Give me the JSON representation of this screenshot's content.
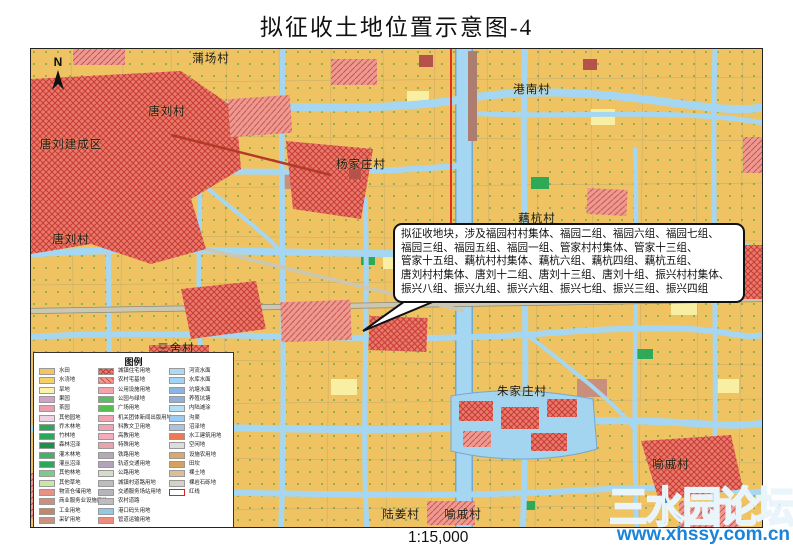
{
  "title": "拟征收土地位置示意图-4",
  "scale_label": "1:15,000",
  "north_label": "N",
  "watermark": {
    "site_name": "三水园论坛",
    "url": "www.xhssy.com.cn"
  },
  "callout": {
    "lines": [
      "拟征收地块，涉及福园村村集体、福园二组、福园六组、福园七组、",
      "福园三组、福园五组、福园一组、管家村村集体、管家十三组、",
      "管家十五组、藕杭村村集体、藕杭六组、藕杭四组、藕杭五组、",
      "唐刘村村集体、唐刘十二组、唐刘十三组、唐刘十组、振兴村村集体、",
      "振兴八组、振兴九组、振兴六组、振兴七组、振兴三组、振兴四组"
    ]
  },
  "map": {
    "labels": [
      {
        "text": "蒲场村",
        "x": 180,
        "y": 9
      },
      {
        "text": "港南村",
        "x": 501,
        "y": 40
      },
      {
        "text": "唐刘村",
        "x": 136,
        "y": 62
      },
      {
        "text": "唐刘建成区",
        "x": 40,
        "y": 95
      },
      {
        "text": "杨家庄村",
        "x": 330,
        "y": 115
      },
      {
        "text": "唐刘村",
        "x": 40,
        "y": 190
      },
      {
        "text": "藕杭村",
        "x": 506,
        "y": 169
      },
      {
        "text": "三舍村",
        "x": 145,
        "y": 299
      },
      {
        "text": "朱家庄村",
        "x": 491,
        "y": 342
      },
      {
        "text": "喻戚村",
        "x": 640,
        "y": 415
      },
      {
        "text": "陆姜村",
        "x": 145,
        "y": 449
      },
      {
        "text": "陆姜村",
        "x": 370,
        "y": 465
      },
      {
        "text": "喻戚村",
        "x": 432,
        "y": 465
      }
    ]
  },
  "legend": {
    "title": "图例",
    "columns": [
      {
        "x": 5,
        "items": [
          {
            "label": "水田",
            "color": "#F4C366"
          },
          {
            "label": "水浇地",
            "color": "#F4D06A"
          },
          {
            "label": "旱地",
            "color": "#FBF3AC"
          },
          {
            "label": "果园",
            "color": "#CFA3C9"
          },
          {
            "label": "茶园",
            "color": "#E9A0AE"
          },
          {
            "label": "其他园地",
            "color": "#EBD3E3"
          },
          {
            "label": "乔木林地",
            "color": "#2FA65A"
          },
          {
            "label": "竹林地",
            "color": "#2FA65A"
          },
          {
            "label": "森林沼泽",
            "color": "#1F8F4C"
          },
          {
            "label": "灌木林地",
            "color": "#43B269"
          },
          {
            "label": "灌丛沼泽",
            "color": "#2FA65A"
          },
          {
            "label": "其他林地",
            "color": "#7FC98E"
          },
          {
            "label": "其他草地",
            "color": "#CDE6A8"
          },
          {
            "label": "物流仓储用地",
            "color": "#EA9184"
          },
          {
            "label": "商业服务业设施用地",
            "color": "#CE8F7B"
          },
          {
            "label": "工业用地",
            "color": "#C58569"
          },
          {
            "label": "采矿用地",
            "color": "#C79183"
          }
        ]
      },
      {
        "x": 64,
        "items": [
          {
            "label": "城镇住宅用地",
            "color": "#E9796B",
            "pattern": "cross"
          },
          {
            "label": "农村宅基地",
            "color": "#EE9A93",
            "pattern": "diag"
          },
          {
            "label": "公用设施用地",
            "color": "#F2A3AC"
          },
          {
            "label": "公园与绿地",
            "color": "#5BBE63"
          },
          {
            "label": "广场用地",
            "color": "#57BE4E"
          },
          {
            "label": "机关团体新闻出版用地",
            "color": "#F2A3B3"
          },
          {
            "label": "科教文卫用地",
            "color": "#F2A3B3"
          },
          {
            "label": "高教用地",
            "color": "#F3ABBD"
          },
          {
            "label": "特殊用地",
            "color": "#EBA3AB"
          },
          {
            "label": "铁路用地",
            "color": "#B3AAB3"
          },
          {
            "label": "轨道交通用地",
            "color": "#B3A2BA"
          },
          {
            "label": "公路用地",
            "color": "#D6DCC8"
          },
          {
            "label": "城镇村道路用地",
            "color": "#BDBDBD"
          },
          {
            "label": "交通服务场站用地",
            "color": "#B5B5BD"
          },
          {
            "label": "农村道路",
            "color": "#BDBDBD"
          },
          {
            "label": "港口码头用地",
            "color": "#92C8E8"
          },
          {
            "label": "管道运输用地",
            "color": "#EF8B7B"
          }
        ]
      },
      {
        "x": 135,
        "items": [
          {
            "label": "河流水面",
            "color": "#ACDAF5"
          },
          {
            "label": "水库水面",
            "color": "#A5D4F2"
          },
          {
            "label": "坑塘水面",
            "color": "#8FB4DF"
          },
          {
            "label": "养殖坑塘",
            "color": "#8FB0DC"
          },
          {
            "label": "内陆滩涂",
            "color": "#B5E0F2"
          },
          {
            "label": "沟渠",
            "color": "#9ECBEF"
          },
          {
            "label": "沼泽地",
            "color": "#ABC3DB"
          },
          {
            "label": "水工建筑用地",
            "color": "#E97B52"
          },
          {
            "label": "空闲地",
            "color": "#DCDCDC"
          },
          {
            "label": "设施农用地",
            "color": "#DBA968"
          },
          {
            "label": "田坎",
            "color": "#D6A05E"
          },
          {
            "label": "裸土地",
            "color": "#DCBE97"
          },
          {
            "label": "裸岩石砾地",
            "color": "#D6D2C6"
          },
          {
            "label": "红线",
            "color": "#FFFFFF",
            "pattern": "outline"
          }
        ]
      }
    ]
  },
  "colors": {
    "land_tan": "#EFC362",
    "water_blue": "#A6D7F2",
    "urban_red": "#E9796B",
    "hatch_red": "#C63B33",
    "red_line": "#E0201C",
    "watermark_blue": "#1B84D8"
  }
}
